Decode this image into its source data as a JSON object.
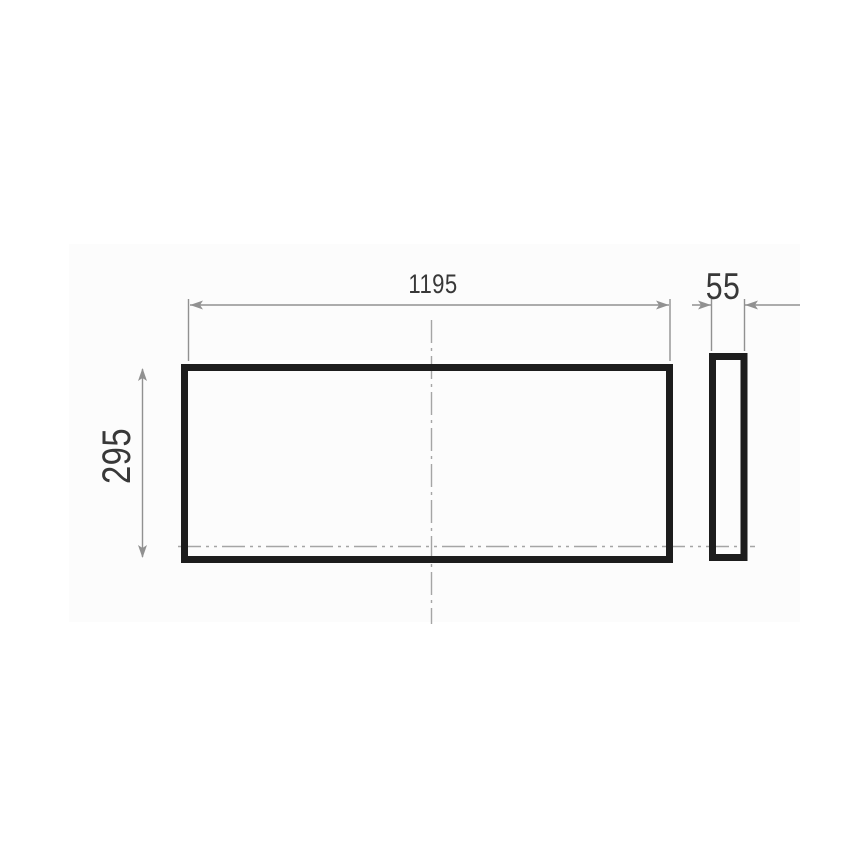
{
  "drawing": {
    "type": "technical-dimension-drawing",
    "front_view": {
      "width_label": "1195",
      "height_label": "295"
    },
    "side_view": {
      "depth_label": "55"
    },
    "colors": {
      "outline": "#1d1d1d",
      "dimension_line": "#919191",
      "centerline": "#a5a5a5",
      "label_text": "#383838",
      "canvas": "#fcfcfc",
      "background": "#ffffff"
    }
  }
}
